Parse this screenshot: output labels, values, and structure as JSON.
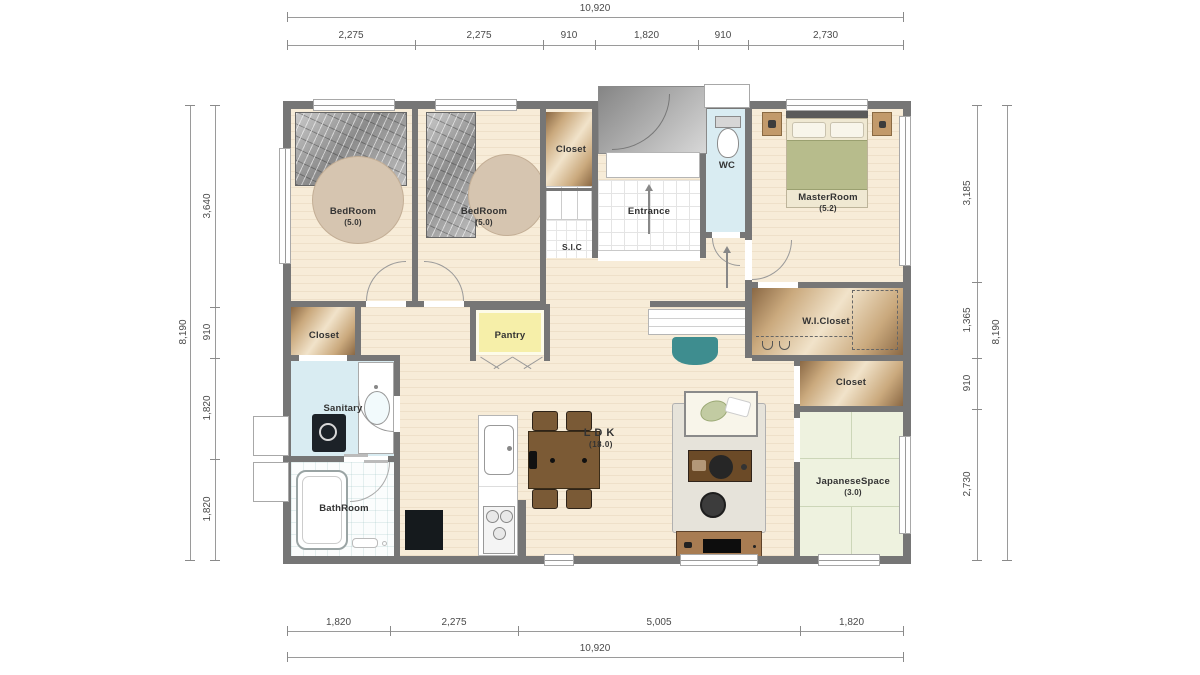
{
  "plan_title": "residential-floor-plan",
  "rooms": {
    "bedroom1": {
      "label": "BedRoom",
      "area": "(5.0)"
    },
    "bedroom2": {
      "label": "BedRoom",
      "area": "(5.0)"
    },
    "closet_top": {
      "label": "Closet"
    },
    "sic": {
      "label": "S.I.C"
    },
    "entrance": {
      "label": "Entrance"
    },
    "wc": {
      "label": "WC"
    },
    "master": {
      "label": "MasterRoom",
      "area": "(5.2)"
    },
    "wic": {
      "label": "W.I.Closet"
    },
    "closet_right": {
      "label": "Closet"
    },
    "japanese": {
      "label": "JapaneseSpace",
      "area": "(3.0)"
    },
    "closet_left": {
      "label": "Closet"
    },
    "pantry": {
      "label": "Pantry"
    },
    "sanitary": {
      "label": "Sanitary"
    },
    "bathroom": {
      "label": "BathRoom"
    },
    "ldk": {
      "label": "LDK",
      "area": "(18.0)"
    }
  },
  "dimensions": {
    "top": {
      "total": "10,920",
      "segments": [
        "2,275",
        "2,275",
        "910",
        "1,820",
        "910",
        "2,730"
      ]
    },
    "bottom": {
      "total": "10,920",
      "segments": [
        "1,820",
        "2,275",
        "5,005",
        "1,820"
      ]
    },
    "left": {
      "total": "8,190",
      "segments": [
        "3,640",
        "910",
        "1,820",
        "1,820"
      ]
    },
    "right": {
      "total": "8,190",
      "segments": [
        "3,185",
        "1,365",
        "910",
        "2,730"
      ]
    }
  },
  "colors": {
    "wall": "#767676",
    "wood_floor": "#f7ecd8",
    "closet_wood": "#caa97d",
    "tatami": "#eef2df",
    "wet_area": "#d9ecf2",
    "pantry": "#f6efa9",
    "accent_teal": "#3e8d8f",
    "furniture_brown": "#7b5a35"
  }
}
